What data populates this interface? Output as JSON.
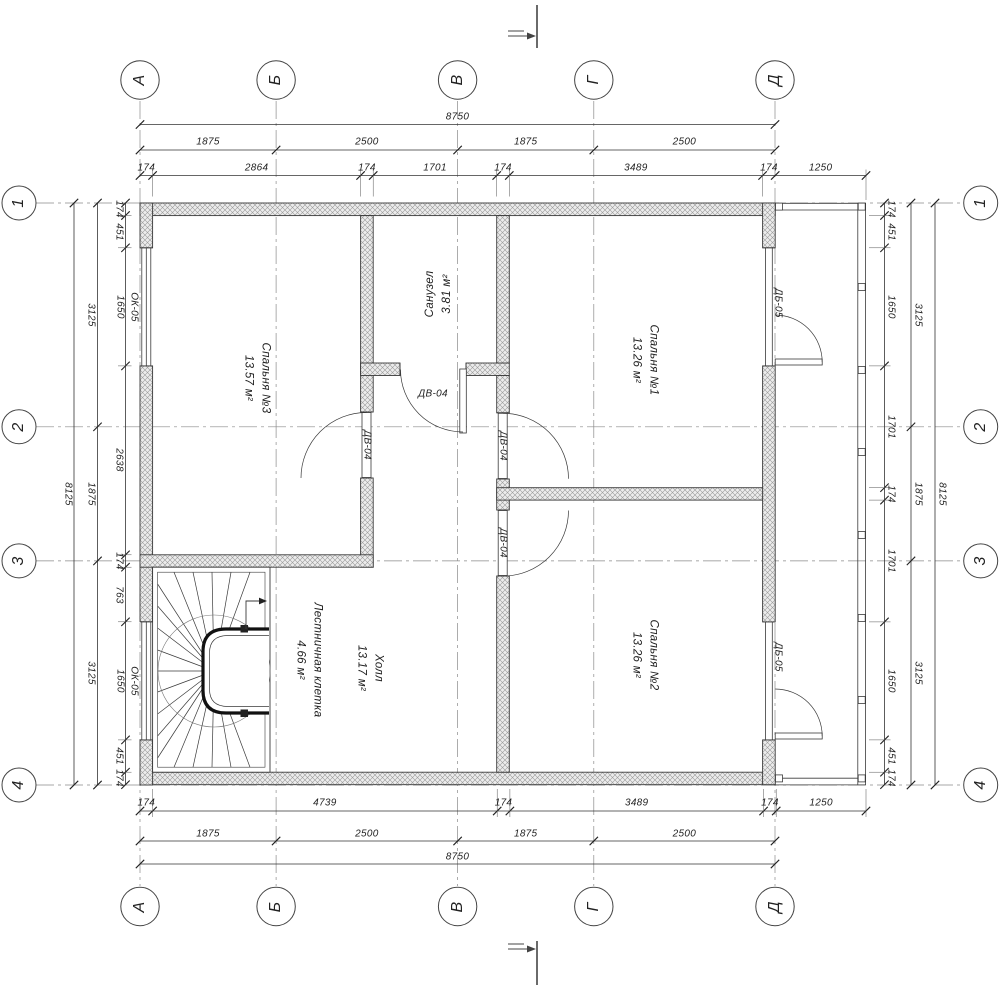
{
  "drawing": {
    "axis_bubbles": {
      "columns": [
        "А",
        "Б",
        "В",
        "Г",
        "Д"
      ],
      "rows": [
        "1",
        "2",
        "3",
        "4"
      ]
    },
    "dimensions": {
      "top": {
        "overall": "8750",
        "axis_spans": [
          "1875",
          "2500",
          "1875",
          "2500"
        ],
        "chain": [
          "174",
          "2864",
          "174",
          "1701",
          "174",
          "3489",
          "174",
          "1250"
        ]
      },
      "bottom": {
        "overall": "8750",
        "axis_spans": [
          "1875",
          "2500",
          "1875",
          "2500"
        ],
        "chain": [
          "174",
          "4739",
          "174",
          "3489",
          "174",
          "1250"
        ]
      },
      "left": {
        "overall": "8125",
        "axis_spans": [
          "3125",
          "1875",
          "3125"
        ],
        "chain": [
          "174",
          "451",
          "1650",
          "2638",
          "174",
          "763",
          "1650",
          "451",
          "174"
        ]
      },
      "right": {
        "overall": "8125",
        "axis_spans": [
          "3125",
          "1875",
          "3125"
        ],
        "chain": [
          "174",
          "451",
          "1650",
          "1701",
          "174",
          "1701",
          "1650",
          "451",
          "174"
        ]
      }
    },
    "rooms": [
      {
        "name": "Спальня №3",
        "area": "13.57 м²"
      },
      {
        "name": "Санузел",
        "area": "3.81 м²"
      },
      {
        "name": "Спальня №1",
        "area": "13.26 м²"
      },
      {
        "name": "Спальня №2",
        "area": "13.26 м²"
      },
      {
        "name": "Холл",
        "area": "13.17 м²"
      },
      {
        "name": "Лестничная клетка",
        "area": "4.66 м²"
      }
    ],
    "opening_tags": {
      "interior_door": "ДВ-04",
      "balcony_door": "ДБ-05",
      "window": "ОК-05",
      "window_width": "1650"
    }
  }
}
